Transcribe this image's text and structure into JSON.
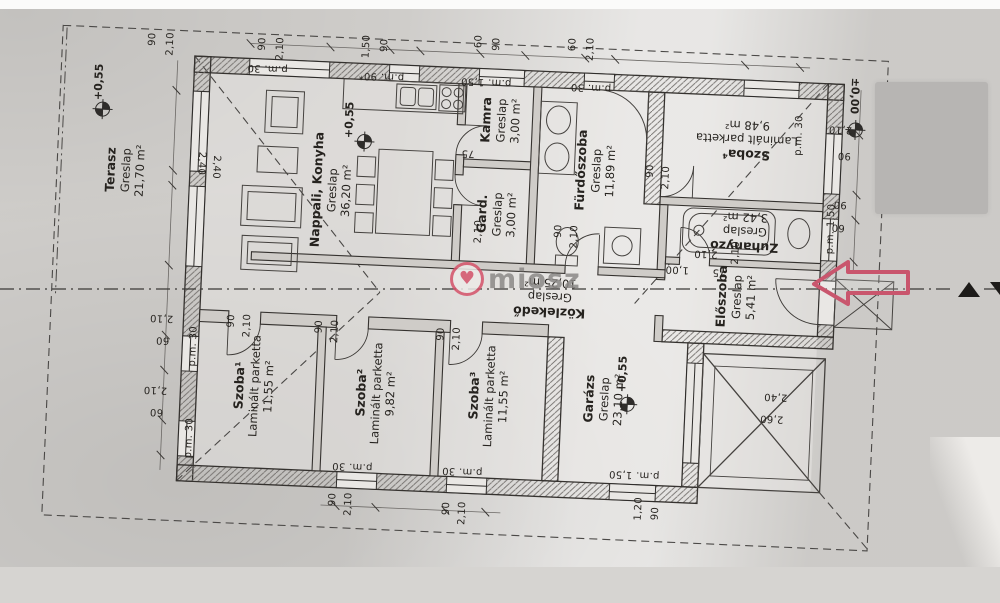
{
  "document": {
    "kind": "scanned floor plan"
  },
  "watermark": {
    "text": "miosz",
    "logo_color": "#d5536a",
    "text_color": "#8b8987"
  },
  "colors": {
    "ink": "#2f2d2b",
    "paper": "#d7d5d2",
    "entrance_arrow": "#c9566d",
    "redaction": "#b7b5b3"
  },
  "rooms": [
    {
      "name": "Terasz",
      "floor": "Greslap",
      "area": "21,70 m²"
    },
    {
      "name": "Nappali, Konyha",
      "floor": "Greslap",
      "area": "36,20 m²"
    },
    {
      "name": "Kamra",
      "floor": "Greslap",
      "area": "3,00 m²"
    },
    {
      "name": "Gard.",
      "floor": "Greslap",
      "area": "3,00 m²"
    },
    {
      "name": "Fürdőszoba",
      "floor": "Greslap",
      "area": "11,89 m²"
    },
    {
      "name": "Szoba⁴",
      "floor": "Laminált parketta",
      "area": "9,48 m²"
    },
    {
      "name": "Zuhanyzó",
      "floor": "Greslap",
      "area": "3,42 m²"
    },
    {
      "name": "Közlekedő",
      "floor": "Greslap",
      "area": "10,25 m²"
    },
    {
      "name": "Előszoba",
      "floor": "Greslap",
      "area": "5,41 m²"
    },
    {
      "name": "Szoba¹",
      "floor": "Laminált parketta",
      "area": "11,55 m²"
    },
    {
      "name": "Szoba²",
      "floor": "Laminált parketta",
      "area": "9,82 m²"
    },
    {
      "name": "Szoba³",
      "floor": "Laminált parketta",
      "area": "11,55 m²"
    },
    {
      "name": "Garázs",
      "floor": "Greslap",
      "area": "23,10 m²"
    }
  ],
  "levels": [
    "+0,55",
    "+0,55",
    "±0,00",
    "+0,55"
  ],
  "dims": [
    "90",
    "2,10",
    "1,50",
    "90",
    "60",
    "90",
    "60",
    "2,10",
    "90",
    "2,10",
    "90",
    "2,10",
    "2,40",
    "2,40",
    "2,10",
    "60",
    "2,10",
    "60",
    "90",
    "2,10",
    "90",
    "2,10",
    "2,10",
    "90",
    "90",
    "60",
    "2,40",
    "2,60",
    "1,20",
    "90",
    "90",
    "2,10",
    "90",
    "2,10",
    "90",
    "2,10",
    "90",
    "2,10",
    "75",
    "2,10",
    "75",
    "2,10",
    "1,00",
    "2,10",
    "p.m. 30",
    "p.m. 90*",
    "p.m. 1,50",
    "p.m. 30",
    "p.m. 30",
    "p.m. 30",
    "p.m. 30",
    "p.m. 30",
    "p.m. 30",
    "p.m. 1,50",
    "p.m. 1,50"
  ]
}
